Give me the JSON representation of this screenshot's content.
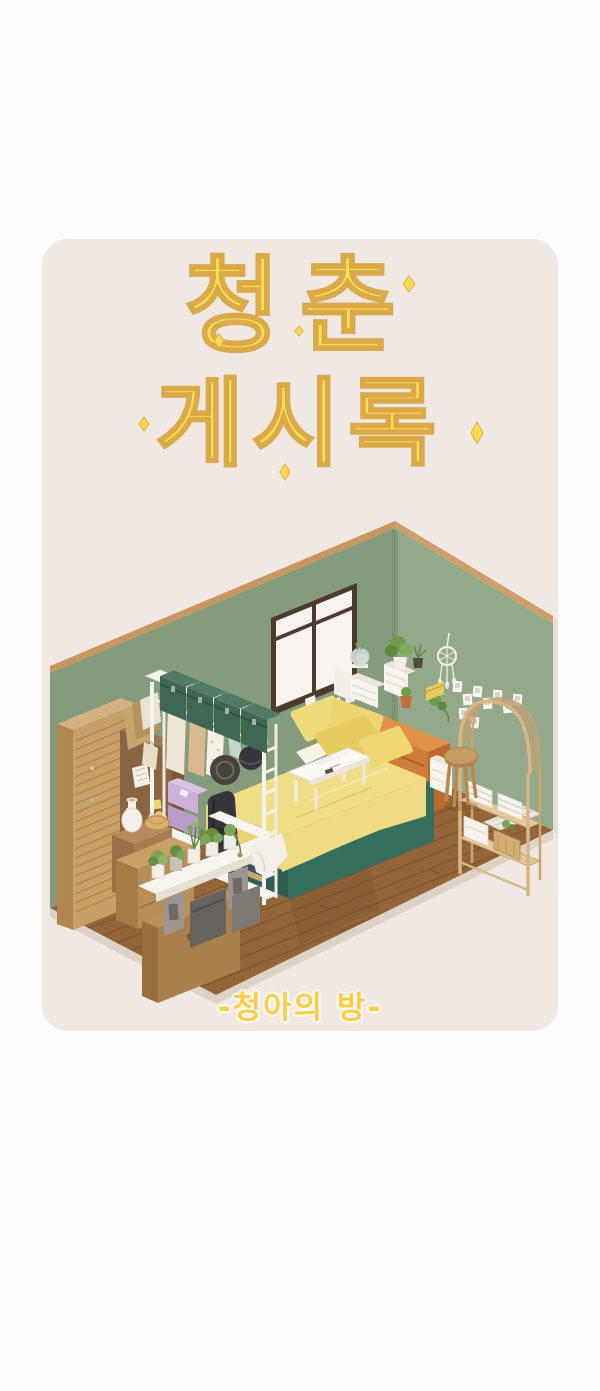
{
  "page": {
    "background_color": "#FEFDFC",
    "card_color": "#F0E9E3"
  },
  "title": {
    "line1": "청춘",
    "line2": "게시록",
    "fill_color": "#FFE14F",
    "outline_color": "#D9A94A"
  },
  "caption": {
    "text": "-청아의 방-",
    "color": "#FFCB49"
  },
  "illustration": {
    "type": "isometric-bedroom-diorama",
    "colors": {
      "wall_left": "#849B7C",
      "wall_right": "#93A98A",
      "trim": "#C89760",
      "floor": "#936539",
      "floor_edge": "#DCD2C6",
      "window_frame": "#4C3A2E",
      "bed_blanket": "#F0DE86",
      "bed_base": "#35705F",
      "dresser_orange": "#CE7C38",
      "rack_white": "#F8F5F0",
      "storage_box_green": "#3E6854",
      "bin_lavender": "#CDAFD8",
      "wardrobe_tan": "#C79F68",
      "rattan": "#D7B787",
      "plant_green": "#7BA557"
    },
    "objects": [
      "window",
      "dreamcatcher",
      "polaroid-photos",
      "wall-notes",
      "orange-dresser",
      "mini-drawer-units",
      "fishbowl",
      "potted-plants",
      "bed-with-yellow-bedding",
      "pillows",
      "tray-table",
      "wooden-stool",
      "white-drawer-box",
      "rattan-arch-shelf",
      "towel-stacks",
      "basket",
      "floor-mat",
      "clothes-rack",
      "green-storage-boxes",
      "hanging-clothes",
      "round-hats",
      "lavender-bins",
      "backpack",
      "books",
      "wicker-wardrobe",
      "cabinet-with-notes",
      "side-table",
      "white-vase",
      "bread-basket",
      "wooden-crates",
      "plant-shelf",
      "cinder-blocks"
    ]
  }
}
